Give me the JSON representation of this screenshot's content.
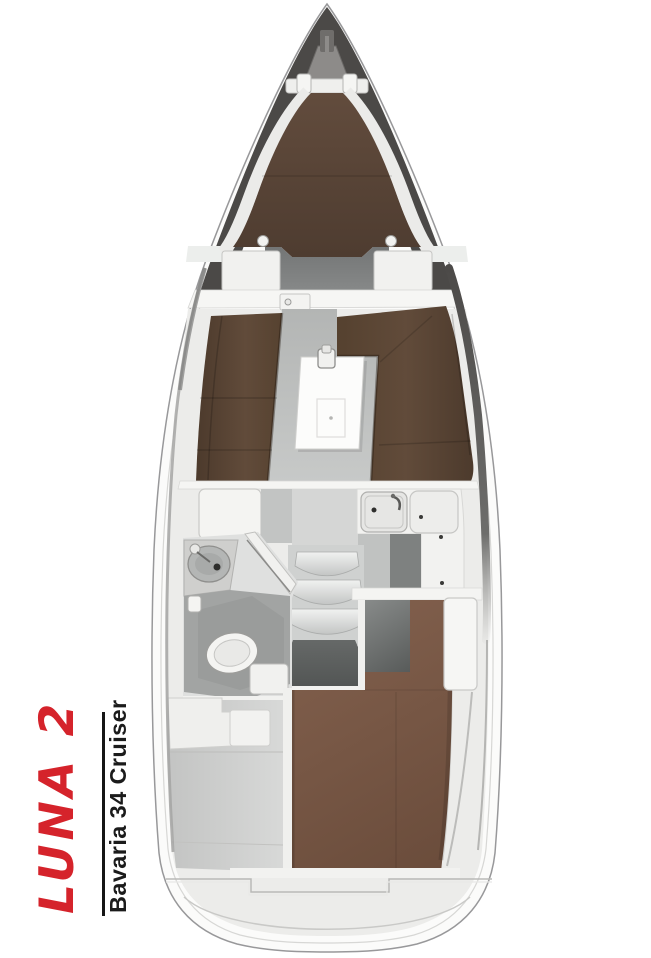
{
  "plan": {
    "boat_name": "LUNA 2",
    "boat_model": "Bavaria 34 Cruiser"
  },
  "colors": {
    "boat_name_red": "#d5232b",
    "model_text_black": "#1b1b1b",
    "deck_dark_gray": "#4b4947",
    "v_berth_brown": "#5a4537",
    "settee_brown": "#5d4838",
    "aft_bed_brown": "#7b5a48",
    "floor_gray": "#bcbebd",
    "dark_floor_gray": "#5d605f",
    "hull_white": "#fbfbfa",
    "wall_white": "#efefed"
  }
}
